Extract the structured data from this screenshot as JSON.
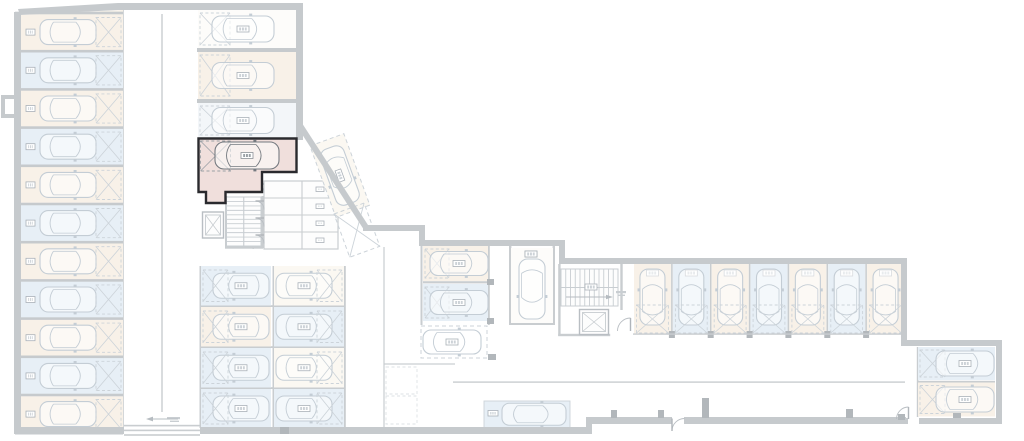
{
  "meta": {
    "width": 1024,
    "height": 441,
    "background": "#ffffff",
    "plan_type": "underground-parking-floor-plan"
  },
  "palette": {
    "wall": "#c6cacd",
    "wallThin": "#c9cdd0",
    "line": "#d4d8db",
    "lineFaint": "#dde2e5",
    "cream": "#f8f1e8",
    "creamPale": "#fbf8f2",
    "blue": "#e7eff6",
    "bluePale": "#f3f6f9",
    "white": "#fdfcfa",
    "pink": "#f0dfdc",
    "pinkBorder": "#2a2a2e",
    "carLight": "#c4cdd5",
    "carDark": "#757a80",
    "hatch": "#ccd3d9",
    "hatchDark": "#9aa0a5",
    "pier": "#b2b7bb",
    "plateStroke": "#aab1b8",
    "stair": "#c9ced2"
  },
  "left_column": {
    "x": 21,
    "w": 102,
    "row_h": 38.2,
    "car": {
      "cx": 66,
      "len": 56,
      "wid": 25
    },
    "xbox": {
      "x": 96,
      "w": 25
    },
    "rows": [
      {
        "y": 13.0,
        "fill": "cream",
        "sloped": true
      },
      {
        "y": 51.2,
        "fill": "blue"
      },
      {
        "y": 89.4,
        "fill": "cream"
      },
      {
        "y": 127.6,
        "fill": "blue"
      },
      {
        "y": 165.8,
        "fill": "cream"
      },
      {
        "y": 204.0,
        "fill": "blue"
      },
      {
        "y": 242.2,
        "fill": "cream"
      },
      {
        "y": 280.4,
        "fill": "blue"
      },
      {
        "y": 318.6,
        "fill": "cream"
      },
      {
        "y": 356.8,
        "fill": "blue"
      },
      {
        "y": 395.0,
        "fill": "cream"
      }
    ]
  },
  "mid_column": {
    "x": 198,
    "w": 98,
    "car": {
      "cx": 243,
      "len": 62,
      "wid": 26
    },
    "spaces": [
      {
        "y": 10,
        "h": 38,
        "fill": "white"
      },
      {
        "y": 52,
        "h": 47,
        "fill": "cream"
      },
      {
        "y": 103,
        "h": 35,
        "fill": "bluePale"
      }
    ]
  },
  "highlight": {
    "points": [
      [
        198.5,
        138.5
      ],
      [
        296.5,
        138.5
      ],
      [
        296.5,
        172
      ],
      [
        262,
        172
      ],
      [
        262,
        192
      ],
      [
        225.5,
        192
      ],
      [
        225.5,
        203
      ],
      [
        206,
        203
      ],
      [
        206,
        192
      ],
      [
        198.5,
        192
      ]
    ],
    "fill": "pink",
    "stroke": "pinkBorder",
    "stroke_w": 2.4,
    "xbox": [
      200.5,
      141,
      30,
      30
    ],
    "car": {
      "cx": 247,
      "cy": 155.5,
      "len": 64,
      "wid": 27,
      "rot": 0
    }
  },
  "stairs": [
    {
      "x": 226.5,
      "y": 197,
      "w": 34.5,
      "h": 49,
      "dir": "v",
      "n": 11
    },
    {
      "x": 561,
      "y": 269,
      "w": 57,
      "h": 37,
      "dir": "h",
      "n": 12
    }
  ],
  "elevators": [
    {
      "x": 202.5,
      "y": 212,
      "w": 21,
      "h": 26
    },
    {
      "x": 579.5,
      "y": 309.5,
      "w": 29,
      "h": 25
    }
  ],
  "rooms": {
    "cols": [
      264,
      302,
      338
    ],
    "rowsY": [
      181,
      198,
      215,
      232,
      249
    ],
    "corridor_x": 253
  },
  "diag_spaces": [
    {
      "ox": 310,
      "oy": 146,
      "rot": -20,
      "w": 36,
      "h": 76,
      "fill": "creamPale",
      "car": true
    },
    {
      "ox": 334,
      "oy": 214,
      "rot": -20,
      "w": 32,
      "h": 46,
      "fill": null,
      "xlines": true
    }
  ],
  "cluster_left": {
    "colA": {
      "x": 201,
      "w": 70
    },
    "colB": {
      "x": 274,
      "w": 70
    },
    "rows": [
      {
        "y": 266,
        "h": 39.5,
        "fa": "blue",
        "fb": "creamPale"
      },
      {
        "y": 307,
        "h": 39.5,
        "fa": "cream",
        "fb": "blue"
      },
      {
        "y": 348,
        "h": 39.5,
        "fa": "blue",
        "fb": "creamPale"
      },
      {
        "y": 389,
        "h": 39.0,
        "fa": "blue",
        "fb": "blue"
      }
    ]
  },
  "cluster_mid": {
    "spaces": [
      {
        "x": 423,
        "y": 246,
        "w": 65,
        "h": 35,
        "fill": "cream",
        "car": {
          "cx": 459,
          "cy": 263.5,
          "rot": 0
        },
        "xbox": [
          425,
          249,
          24,
          29
        ]
      },
      {
        "x": 423,
        "y": 284,
        "w": 65,
        "h": 37,
        "fill": "blue",
        "car": {
          "cx": 459,
          "cy": 302.5,
          "rot": 0
        },
        "xbox": [
          425,
          287,
          24,
          31
        ]
      },
      {
        "x": 511,
        "y": 248,
        "w": 42,
        "h": 75,
        "fill": "white",
        "car": {
          "cx": 532,
          "cy": 289,
          "rot": 90
        },
        "plate": [
          525,
          251
        ]
      },
      {
        "x": 421,
        "y": 326,
        "w": 66,
        "h": 32,
        "fill": null,
        "dash": true,
        "car": {
          "cx": 452,
          "cy": 342,
          "rot": 0
        }
      }
    ]
  },
  "row7": {
    "y": 264,
    "h": 70,
    "xs": [
      633,
      671.9,
      710.7,
      749.6,
      788.4,
      827.3,
      866.1,
      905
    ],
    "fills": [
      "cream",
      "blue",
      "cream",
      "blue",
      "cream",
      "blue",
      "cream"
    ]
  },
  "right_block": {
    "spaces": [
      {
        "x": 918,
        "y": 347,
        "w": 77,
        "h": 33,
        "fill": "blue"
      },
      {
        "x": 918,
        "y": 382.5,
        "w": 77,
        "h": 34,
        "fill": "cream"
      }
    ]
  },
  "bottom_space": {
    "x": 484,
    "y": 401,
    "w": 86,
    "h": 26.5,
    "fill": "blue",
    "plate": [
      488,
      410.5
    ]
  },
  "walls": {
    "top_poly": [
      [
        18,
        9
      ],
      [
        118,
        3
      ],
      [
        303,
        3
      ],
      [
        303,
        10
      ],
      [
        118,
        10
      ],
      [
        20,
        15
      ]
    ],
    "rects": [
      [
        296,
        3,
        7,
        137
      ],
      [
        363,
        225,
        62,
        6
      ],
      [
        419,
        225,
        6,
        21
      ],
      [
        419,
        240,
        146,
        6
      ],
      [
        559,
        240,
        6,
        24
      ],
      [
        559,
        258,
        348,
        6
      ],
      [
        901,
        258,
        6,
        88
      ],
      [
        901,
        340,
        101,
        6
      ],
      [
        996,
        340,
        6,
        84
      ],
      [
        903,
        418,
        5,
        6
      ],
      [
        919,
        418,
        83,
        6
      ],
      [
        590,
        417,
        82,
        7
      ],
      [
        684,
        417,
        222,
        7
      ],
      [
        586,
        417,
        6,
        17
      ],
      [
        200,
        427,
        390,
        7
      ],
      [
        14,
        427,
        110,
        7
      ],
      [
        14,
        12,
        7,
        421
      ],
      [
        1,
        95,
        14,
        4
      ],
      [
        1,
        95,
        4,
        23
      ],
      [
        1,
        114,
        14,
        4
      ],
      [
        197,
        48,
        101,
        4
      ],
      [
        197,
        99,
        101,
        4
      ]
    ],
    "diag": {
      "x1": 299,
      "y1": 124,
      "x2": 367,
      "y2": 229,
      "w": 6
    }
  },
  "thin_rects": [
    [
      225,
      196,
      2.2,
      52
    ],
    [
      261.5,
      196,
      2.2,
      52
    ],
    [
      225,
      246.5,
      38,
      2.2
    ],
    [
      199.5,
      266,
      1.8,
      162
    ],
    [
      272.5,
      266,
      1.8,
      162
    ],
    [
      344,
      266,
      1.8,
      162
    ],
    [
      201,
      305.2,
      143,
      1.8
    ],
    [
      201,
      346.2,
      143,
      1.8
    ],
    [
      201,
      387.2,
      143,
      1.8
    ],
    [
      420.5,
      246,
      2,
      79
    ],
    [
      423,
      281.2,
      65,
      2.2
    ],
    [
      487.8,
      246,
      2,
      79
    ],
    [
      509,
      246,
      2.4,
      79
    ],
    [
      552.6,
      246,
      2.4,
      79
    ],
    [
      509,
      322.6,
      46,
      2.4
    ],
    [
      558.2,
      264,
      2.4,
      72
    ],
    [
      620.3,
      264,
      2.4,
      46
    ],
    [
      558.2,
      333.8,
      52,
      2.4
    ],
    [
      916.8,
      347,
      1.6,
      70
    ],
    [
      918,
      380.8,
      77,
      1.8
    ],
    [
      122.6,
      10,
      1.2,
      417
    ],
    [
      161.3,
      14,
      1.4,
      398
    ],
    [
      383.4,
      247,
      1.2,
      180
    ],
    [
      384,
      363.4,
      71,
      1.2
    ],
    [
      453,
      381.4,
      452,
      1.4
    ],
    [
      124,
      424.8,
      76,
      1.6
    ],
    [
      124,
      429.6,
      76,
      1.6
    ],
    [
      124,
      434.2,
      76,
      1.6
    ],
    [
      252.6,
      197,
      1.2,
      52
    ]
  ],
  "dashed_cells": [
    [
      386,
      367,
      31,
      27
    ],
    [
      386,
      396,
      31,
      28
    ]
  ],
  "piers": [
    [
      611,
      410,
      6,
      8
    ],
    [
      658,
      410,
      6,
      8
    ],
    [
      702,
      398,
      7,
      20
    ],
    [
      846,
      409,
      7,
      9
    ],
    [
      898,
      414,
      7,
      6
    ],
    [
      953,
      413,
      8,
      5
    ],
    [
      280,
      427,
      9,
      7
    ],
    [
      487,
      279,
      7,
      6
    ],
    [
      487,
      318,
      7,
      6
    ],
    [
      488,
      354,
      8,
      6
    ]
  ],
  "doors": [
    {
      "path": "M 672 431 A 12.5 12.5 0 0 1 684.5 418.5",
      "leaf": [
        672,
        418.5,
        672,
        431
      ]
    },
    {
      "path": "M 896.5 419 A 12 12 0 0 1 908.5 407",
      "leaf": [
        908.5,
        407,
        908.5,
        419
      ]
    },
    {
      "path": "M 617.5 331 A 13 13 0 0 1 630.5 318",
      "leaf": [
        630.5,
        318,
        630.5,
        331
      ]
    },
    {
      "path": "M 255.5 184 A 8.5 8.5 0 0 1 264 192.5",
      "leaf": [
        264,
        184,
        255.5,
        184
      ]
    },
    {
      "path": "M 255.5 201 A 8.5 8.5 0 0 1 264 209.5",
      "leaf": [
        264,
        201,
        255.5,
        201
      ]
    },
    {
      "path": "M 255.5 218 A 8.5 8.5 0 0 1 264 226.5",
      "leaf": [
        264,
        218,
        255.5,
        218
      ]
    },
    {
      "path": "M 255.5 235 A 8.5 8.5 0 0 1 264 243.5",
      "leaf": [
        264,
        235,
        255.5,
        235
      ]
    }
  ],
  "plates": [
    [
      525,
      251,
      12,
      6
    ],
    [
      585,
      284,
      12,
      6
    ],
    [
      488,
      410.5,
      10,
      5.5
    ]
  ],
  "smudges": [
    [
      167,
      417,
      13,
      2.2
    ],
    [
      170,
      420.6,
      9,
      1.4
    ],
    [
      616,
      291,
      10,
      2.2
    ],
    [
      618,
      294.6,
      7,
      1.4
    ]
  ],
  "arrows": [
    {
      "line": [
        178,
        419,
        149,
        419
      ],
      "head": [
        [
          146,
          419
        ],
        [
          153,
          416.6
        ],
        [
          153,
          421.4
        ]
      ]
    },
    {
      "line": [
        566,
        297,
        609,
        297
      ],
      "head": [
        [
          613,
          297
        ],
        [
          606,
          294.8
        ],
        [
          606,
          299.2
        ]
      ]
    }
  ]
}
